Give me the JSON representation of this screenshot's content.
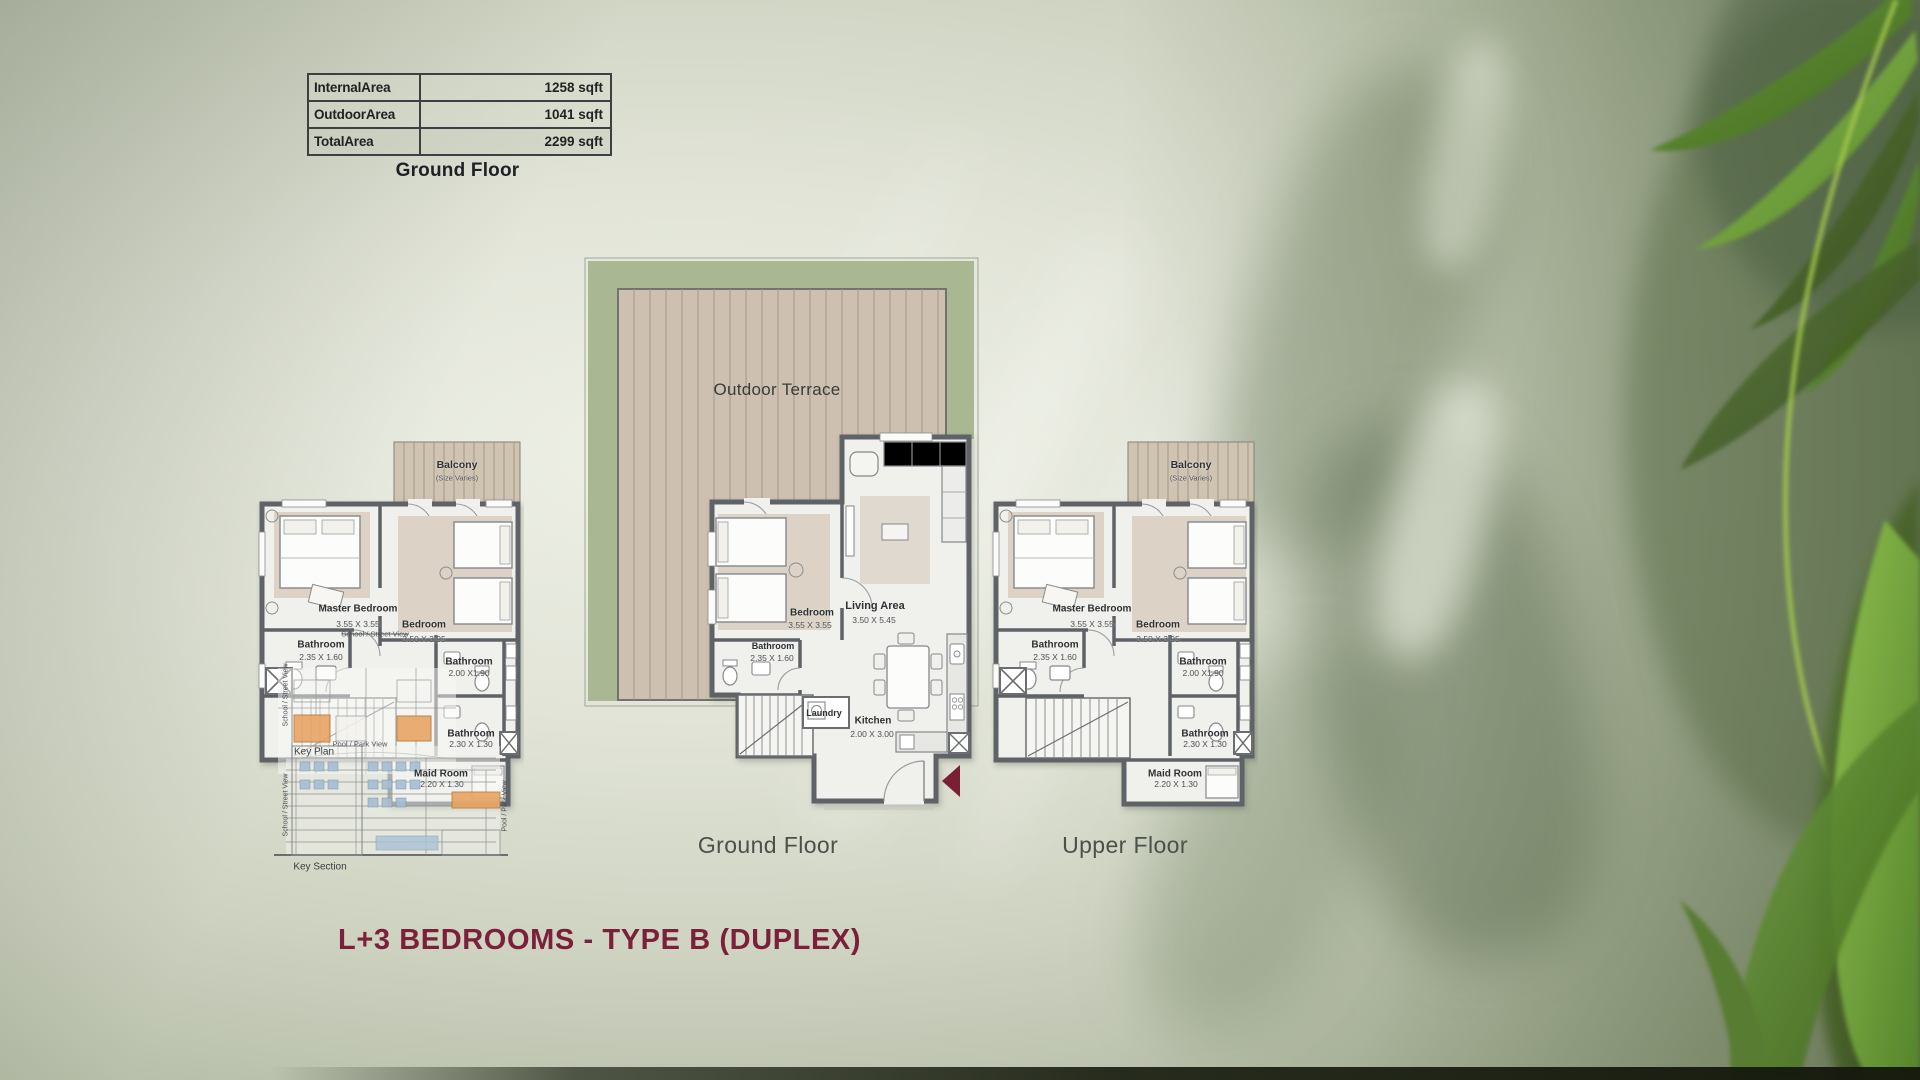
{
  "title": "L+3 BEDROOMS - TYPE B (DUPLEX)",
  "area_table": {
    "caption": "Ground Floor",
    "rows": [
      {
        "label": "InternalArea",
        "value": "1258 sqft"
      },
      {
        "label": "OutdoorArea",
        "value": "1041 sqft"
      },
      {
        "label": "TotalArea",
        "value": "2299 sqft"
      }
    ]
  },
  "plans": {
    "ground": {
      "caption": "Ground Floor",
      "terrace_label": "Outdoor Terrace",
      "rooms": [
        {
          "name": "Bedroom",
          "dims": "3.55 X 3.55"
        },
        {
          "name": "Living Area",
          "dims": "3.50 X 5.45"
        },
        {
          "name": "Bathroom",
          "dims": "2.35 X 1.60"
        },
        {
          "name": "Laundry",
          "dims": ""
        },
        {
          "name": "Kitchen",
          "dims": "2.00 X 3.00"
        }
      ]
    },
    "upper": {
      "caption": "Upper Floor",
      "balcony": {
        "label": "Balcony",
        "note": "(Size Varies)"
      },
      "rooms": [
        {
          "name": "Master Bedroom",
          "dims": "3.55 X 3.55"
        },
        {
          "name": "Bedroom",
          "dims": "3.50 X 3.95"
        },
        {
          "name": "Bathroom",
          "dims": "2.35 X 1.60"
        },
        {
          "name": "Bathroom",
          "dims": "2.00 X1.90"
        },
        {
          "name": "Bathroom",
          "dims": "2.30 X 1.30"
        },
        {
          "name": "Maid Room",
          "dims": "2.20 X 1.30"
        }
      ],
      "overlays": {
        "key_plan": "Key Plan",
        "key_section": "Key Section",
        "pool_park": "Pool / Park View",
        "school_street": "School / Street View"
      }
    }
  },
  "colors": {
    "accent_maroon": "#7b1f3a",
    "hedge_green": "#a9b793",
    "deck_tan": "#cdc0b0",
    "wall_grey": "#5e6266",
    "highlight_orange": "#e9a769",
    "section_glass_blue": "#a9c0d4"
  }
}
